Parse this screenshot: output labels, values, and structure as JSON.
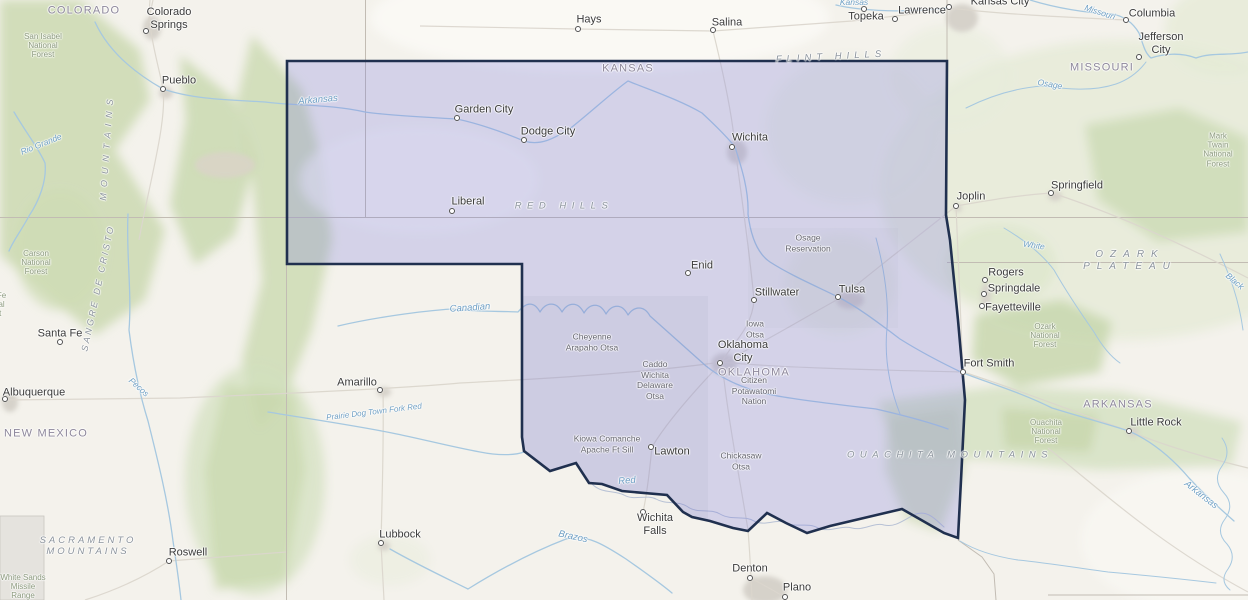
{
  "map": {
    "colors": {
      "selection_fill": "#d4d3e9",
      "selection_border": "#20304f",
      "land": "#f4f2ec",
      "forest_green": "#cbd9b1",
      "water_blue": "#a6c8e0",
      "state_line": "#c2bcb3"
    }
  },
  "city_labels": [
    {
      "text": "Colorado\nSprings",
      "x": 169,
      "y": 19
    },
    {
      "text": "Pueblo",
      "x": 179,
      "y": 81
    },
    {
      "text": "Hays",
      "x": 589,
      "y": 20
    },
    {
      "text": "Salina",
      "x": 727,
      "y": 23
    },
    {
      "text": "Topeka",
      "x": 866,
      "y": 17
    },
    {
      "text": "Lawrence",
      "x": 922,
      "y": 11
    },
    {
      "text": "Kansas City",
      "x": 1000,
      "y": 2
    },
    {
      "text": "Columbia",
      "x": 1152,
      "y": 14
    },
    {
      "text": "Jefferson\nCity",
      "x": 1161,
      "y": 44
    },
    {
      "text": "Springfield",
      "x": 1077,
      "y": 186
    },
    {
      "text": "Joplin",
      "x": 971,
      "y": 197
    },
    {
      "text": "Garden City",
      "x": 484,
      "y": 110
    },
    {
      "text": "Dodge City",
      "x": 548,
      "y": 132
    },
    {
      "text": "Wichita",
      "x": 750,
      "y": 138
    },
    {
      "text": "Liberal",
      "x": 468,
      "y": 202
    },
    {
      "text": "Enid",
      "x": 702,
      "y": 266
    },
    {
      "text": "Stillwater",
      "x": 777,
      "y": 293
    },
    {
      "text": "Tulsa",
      "x": 852,
      "y": 290
    },
    {
      "text": "Oklahoma\nCity",
      "x": 743,
      "y": 352
    },
    {
      "text": "Santa Fe",
      "x": 60,
      "y": 334
    },
    {
      "text": "Albuquerque",
      "x": 34,
      "y": 393
    },
    {
      "text": "Amarillo",
      "x": 357,
      "y": 383
    },
    {
      "text": "Lawton",
      "x": 672,
      "y": 452
    },
    {
      "text": "Wichita\nFalls",
      "x": 655,
      "y": 525
    },
    {
      "text": "Lubbock",
      "x": 400,
      "y": 535
    },
    {
      "text": "Roswell",
      "x": 188,
      "y": 553
    },
    {
      "text": "Denton",
      "x": 750,
      "y": 569
    },
    {
      "text": "Plano",
      "x": 797,
      "y": 588
    },
    {
      "text": "Fort Smith",
      "x": 989,
      "y": 364
    },
    {
      "text": "Rogers",
      "x": 1006,
      "y": 273
    },
    {
      "text": "Springdale",
      "x": 1014,
      "y": 289
    },
    {
      "text": "Fayetteville",
      "x": 1013,
      "y": 308
    },
    {
      "text": "Little Rock",
      "x": 1156,
      "y": 423
    }
  ],
  "city_dots": [
    {
      "x": 146,
      "y": 31
    },
    {
      "x": 163,
      "y": 89
    },
    {
      "x": 578,
      "y": 29
    },
    {
      "x": 713,
      "y": 30
    },
    {
      "x": 864,
      "y": 9
    },
    {
      "x": 895,
      "y": 19
    },
    {
      "x": 949,
      "y": 7
    },
    {
      "x": 1126,
      "y": 20
    },
    {
      "x": 1139,
      "y": 57
    },
    {
      "x": 1051,
      "y": 193
    },
    {
      "x": 956,
      "y": 206
    },
    {
      "x": 457,
      "y": 118
    },
    {
      "x": 524,
      "y": 140
    },
    {
      "x": 732,
      "y": 147
    },
    {
      "x": 452,
      "y": 211
    },
    {
      "x": 688,
      "y": 273
    },
    {
      "x": 754,
      "y": 300
    },
    {
      "x": 838,
      "y": 297
    },
    {
      "x": 720,
      "y": 363
    },
    {
      "x": 60,
      "y": 342
    },
    {
      "x": 5,
      "y": 399
    },
    {
      "x": 380,
      "y": 390
    },
    {
      "x": 651,
      "y": 447
    },
    {
      "x": 643,
      "y": 512
    },
    {
      "x": 381,
      "y": 543
    },
    {
      "x": 169,
      "y": 561
    },
    {
      "x": 750,
      "y": 578
    },
    {
      "x": 785,
      "y": 597
    },
    {
      "x": 963,
      "y": 372
    },
    {
      "x": 985,
      "y": 280
    },
    {
      "x": 984,
      "y": 294
    },
    {
      "x": 982,
      "y": 306
    },
    {
      "x": 1129,
      "y": 431
    }
  ],
  "state_labels": [
    {
      "text": "COLORADO",
      "x": 84,
      "y": 11
    },
    {
      "text": "KANSAS",
      "x": 628,
      "y": 69
    },
    {
      "text": "MISSOURI",
      "x": 1102,
      "y": 68
    },
    {
      "text": "OKLAHOMA",
      "x": 754,
      "y": 373
    },
    {
      "text": "ARKANSAS",
      "x": 1118,
      "y": 405
    },
    {
      "text": "NEW MEXICO",
      "x": 46,
      "y": 434
    }
  ],
  "physical_labels": [
    {
      "text": "FLINT HILLS",
      "x": 831,
      "y": 57,
      "rot": -3,
      "ls": 5
    },
    {
      "text": "RED HILLS",
      "x": 564,
      "y": 206,
      "ls": 5.5
    },
    {
      "text": "OZARK PLATEAU",
      "x": 1130,
      "y": 261,
      "ls": 7,
      "fs": 10
    },
    {
      "text": "OUACHITA MOUNTAINS",
      "x": 950,
      "y": 455,
      "ls": 5.5
    },
    {
      "text": "SACRAMENTO\nMOUNTAINS",
      "x": 88,
      "y": 546,
      "ls": 3
    },
    {
      "text": "SANGRE DE CRISTO",
      "x": 98,
      "y": 288,
      "rot": -78,
      "ls": 2.5,
      "fs": 9
    },
    {
      "text": "MOUNTAINS",
      "x": 107,
      "y": 147,
      "rot": -86,
      "ls": 6,
      "fs": 9
    }
  ],
  "river_labels": [
    {
      "text": "Arkansas",
      "x": 318,
      "y": 100,
      "rot": -5
    },
    {
      "text": "Arkansas",
      "x": 1201,
      "y": 495,
      "rot": 38
    },
    {
      "text": "Canadian",
      "x": 470,
      "y": 308,
      "rot": -4
    },
    {
      "text": "Pecos",
      "x": 139,
      "y": 387,
      "rot": 42,
      "fs": 8.5
    },
    {
      "text": "Rio Grande",
      "x": 41,
      "y": 144,
      "rot": -22,
      "fs": 8.5
    },
    {
      "text": "Red",
      "x": 627,
      "y": 481,
      "rot": -5
    },
    {
      "text": "Brazos",
      "x": 573,
      "y": 537,
      "rot": 12
    },
    {
      "text": "White",
      "x": 1034,
      "y": 245,
      "rot": 8,
      "fs": 8.5
    },
    {
      "text": "Osage",
      "x": 1050,
      "y": 84,
      "rot": 10,
      "fs": 8.5
    },
    {
      "text": "Missouri",
      "x": 1100,
      "y": 12,
      "rot": 18,
      "fs": 8.5
    },
    {
      "text": "Black",
      "x": 1235,
      "y": 281,
      "rot": 40,
      "fs": 8.5
    },
    {
      "text": "Prairie Dog Town Fork Red",
      "x": 374,
      "y": 412,
      "rot": -7,
      "fs": 8
    },
    {
      "text": "Kansas",
      "x": 854,
      "y": 2,
      "fs": 8.5
    }
  ],
  "forest_labels": [
    {
      "text": "San Isabel\nNational\nForest",
      "x": 43,
      "y": 46
    },
    {
      "text": "Carson\nNational\nForest",
      "x": 36,
      "y": 263
    },
    {
      "text": "Santa Fe\nNational\nForest",
      "x": -10,
      "y": 305
    },
    {
      "text": "Mark Twain\nNational\nForest",
      "x": 1218,
      "y": 150
    },
    {
      "text": "Ozark\nNational\nForest",
      "x": 1045,
      "y": 336
    },
    {
      "text": "Ouachita\nNational\nForest",
      "x": 1046,
      "y": 432
    },
    {
      "text": "White Sands\nMissile\nRange",
      "x": 23,
      "y": 587
    }
  ],
  "area_labels": [
    {
      "text": "Osage\nReservation",
      "x": 808,
      "y": 243
    },
    {
      "text": "Iowa\nOtsa",
      "x": 755,
      "y": 329
    },
    {
      "text": "Cheyenne\nArapaho Otsa",
      "x": 592,
      "y": 342
    },
    {
      "text": "Caddo\nWichita\nDelaware\nOtsa",
      "x": 655,
      "y": 380
    },
    {
      "text": "Citizen\nPotawatomi\nNation",
      "x": 754,
      "y": 391
    },
    {
      "text": "Kiowa Comanche\nApache Ft Sill",
      "x": 607,
      "y": 444
    },
    {
      "text": "Chickasaw\nOtsa",
      "x": 741,
      "y": 461
    }
  ]
}
